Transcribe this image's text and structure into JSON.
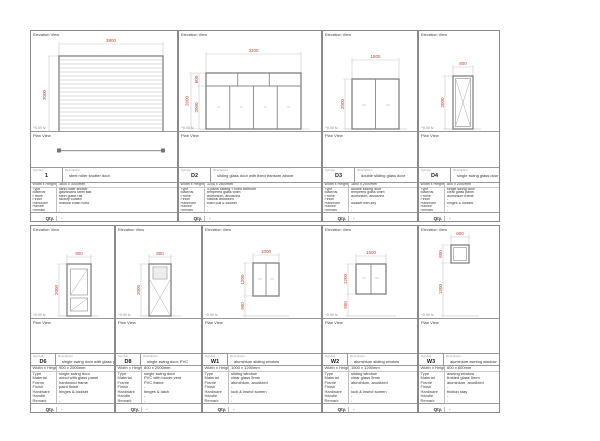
{
  "labels": {
    "elevation": "Elevation View",
    "plan": "Plan View",
    "symbol": "Symbol",
    "description": "Description",
    "qty": "Qty.",
    "floor": "+0.00 lv."
  },
  "colors": {
    "dimension_red": "#c0443c",
    "line_gray": "#8a8a8a"
  },
  "panels": [
    {
      "code": "1",
      "description": "steel roller shutter door",
      "qty": "-",
      "dims": {
        "top": "3800",
        "left": "3000"
      },
      "specs": [
        {
          "l": "Width x Height",
          "v": "3800 x 3000mm"
        },
        {
          "l": "Type",
          "v": "steel roller shutter"
        },
        {
          "l": "Material",
          "v": "galvanized steel slat"
        },
        {
          "l": "Frame",
          "v": "steel guide rail"
        },
        {
          "l": "Finish",
          "v": "factory coated"
        },
        {
          "l": "Hardware",
          "v": "manual chain hoist"
        },
        {
          "l": "Handle",
          "v": "-"
        },
        {
          "l": "Remark",
          "v": "-"
        }
      ]
    },
    {
      "code": "D2",
      "description": "sliding glass door with fixed transom above",
      "qty": "-",
      "dims": {
        "top": "3200",
        "left_total": "2600",
        "left_top": "600",
        "left_bottom": "2000"
      },
      "specs": [
        {
          "l": "Width x Height",
          "v": "3200 x 2600mm"
        },
        {
          "l": "Type",
          "v": "4-panel sliding + fixed transom"
        },
        {
          "l": "Material",
          "v": "tempered glass 6mm"
        },
        {
          "l": "Frame",
          "v": "aluminium, anodized"
        },
        {
          "l": "Finish",
          "v": "natural anodized"
        },
        {
          "l": "Hardware",
          "v": "flush pull & lockset"
        },
        {
          "l": "Handle",
          "v": "-"
        },
        {
          "l": "Remark",
          "v": "-"
        }
      ]
    },
    {
      "code": "D3",
      "description": "double sliding glass door",
      "qty": "-",
      "dims": {
        "top": "1800",
        "left": "2000"
      },
      "specs": [
        {
          "l": "Width x Height",
          "v": "1800 x 2000mm"
        },
        {
          "l": "Type",
          "v": "double sliding door"
        },
        {
          "l": "Material",
          "v": "tempered glass 6mm"
        },
        {
          "l": "Frame",
          "v": "aluminium, anodized"
        },
        {
          "l": "Finish",
          "v": "-"
        },
        {
          "l": "Hardware",
          "v": "lockset with key"
        },
        {
          "l": "Handle",
          "v": "-"
        },
        {
          "l": "Remark",
          "v": "-"
        }
      ]
    },
    {
      "code": "D4",
      "description": "single swing glass door",
      "qty": "-",
      "dims": {
        "top": "800",
        "left": "2000"
      },
      "specs": [
        {
          "l": "Width x Height",
          "v": "800 x 2000mm"
        },
        {
          "l": "Type",
          "v": "single swing door"
        },
        {
          "l": "Material",
          "v": "clear glass panel"
        },
        {
          "l": "Frame",
          "v": "aluminium frame"
        },
        {
          "l": "Finish",
          "v": "-"
        },
        {
          "l": "Hardware",
          "v": "hinges & lockset"
        },
        {
          "l": "Handle",
          "v": "-"
        },
        {
          "l": "Remark",
          "v": "-"
        }
      ]
    },
    {
      "code": "D6",
      "description": "single swing door with glass panel",
      "qty": "-",
      "dims": {
        "top": "900",
        "left": "2000"
      },
      "specs": [
        {
          "l": "Width x Height",
          "v": "900 x 2000mm"
        },
        {
          "l": "Type",
          "v": "single swing door"
        },
        {
          "l": "Material",
          "v": "wood with glass panel"
        },
        {
          "l": "Frame",
          "v": "hardwood frame"
        },
        {
          "l": "Finish",
          "v": "paint finish"
        },
        {
          "l": "Hardware",
          "v": "hinges & lockset"
        },
        {
          "l": "Handle",
          "v": "-"
        },
        {
          "l": "Remark",
          "v": "-"
        }
      ]
    },
    {
      "code": "D8",
      "description": "single swing door, PVC",
      "qty": "-",
      "dims": {
        "top": "800",
        "left": "2000"
      },
      "specs": [
        {
          "l": "Width x Height",
          "v": "800 x 2000mm"
        },
        {
          "l": "Type",
          "v": "single swing door"
        },
        {
          "l": "Material",
          "v": "PVC with louver vent"
        },
        {
          "l": "Frame",
          "v": "PVC frame"
        },
        {
          "l": "Finish",
          "v": "-"
        },
        {
          "l": "Hardware",
          "v": "hinges & latch"
        },
        {
          "l": "Handle",
          "v": "-"
        },
        {
          "l": "Remark",
          "v": "-"
        }
      ]
    },
    {
      "code": "W1",
      "description": "aluminium sliding window",
      "qty": "-",
      "dims": {
        "top": "1000",
        "left": "1200",
        "sill": "900"
      },
      "specs": [
        {
          "l": "Width x Height",
          "v": "1000 x 1200mm"
        },
        {
          "l": "Type",
          "v": "sliding window"
        },
        {
          "l": "Material",
          "v": "clear glass 5mm"
        },
        {
          "l": "Frame",
          "v": "aluminium, anodized"
        },
        {
          "l": "Finish",
          "v": "-"
        },
        {
          "l": "Hardware",
          "v": "lock & insect screen"
        },
        {
          "l": "Handle",
          "v": "-"
        },
        {
          "l": "Remark",
          "v": "-"
        }
      ]
    },
    {
      "code": "W2",
      "description": "aluminium sliding window",
      "qty": "-",
      "dims": {
        "top": "1500",
        "left": "1200",
        "sill": "900"
      },
      "specs": [
        {
          "l": "Width x Height",
          "v": "1500 x 1200mm"
        },
        {
          "l": "Type",
          "v": "sliding window"
        },
        {
          "l": "Material",
          "v": "clear glass 5mm"
        },
        {
          "l": "Frame",
          "v": "aluminium, anodized"
        },
        {
          "l": "Finish",
          "v": "-"
        },
        {
          "l": "Hardware",
          "v": "lock & insect screen"
        },
        {
          "l": "Handle",
          "v": "-"
        },
        {
          "l": "Remark",
          "v": "-"
        }
      ]
    },
    {
      "code": "W3",
      "description": "aluminium awning window",
      "qty": "-",
      "dims": {
        "top": "600",
        "left": "600",
        "below": "1500"
      },
      "specs": [
        {
          "l": "Width x Height",
          "v": "600 x 600mm"
        },
        {
          "l": "Type",
          "v": "awning window"
        },
        {
          "l": "Material",
          "v": "frosted glass 5mm"
        },
        {
          "l": "Frame",
          "v": "aluminium, anodized"
        },
        {
          "l": "Finish",
          "v": "-"
        },
        {
          "l": "Hardware",
          "v": "friction stay"
        },
        {
          "l": "Handle",
          "v": "-"
        },
        {
          "l": "Remark",
          "v": "-"
        }
      ]
    }
  ]
}
